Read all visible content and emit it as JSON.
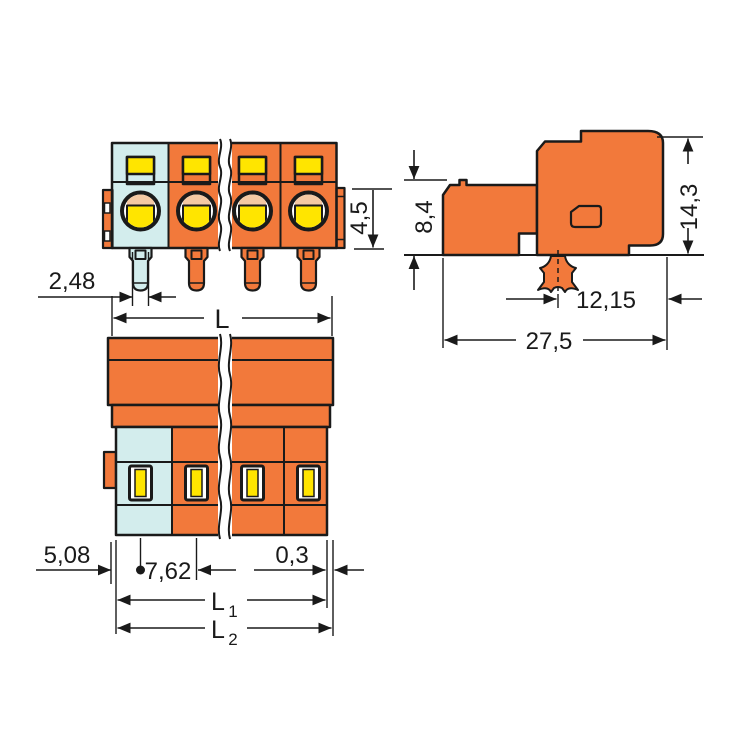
{
  "drawing_type": "connector-dimension-drawing",
  "colors": {
    "orange": "#F2793B",
    "cyan": "#D3EDED",
    "yellow": "#FFE500",
    "peach": "#F5C9A3",
    "line": "#1A1A1A",
    "background": "#FFFFFF"
  },
  "views": {
    "front": {
      "dims": {
        "pin_width": "2,48",
        "latch_height": "4,5",
        "length": "L"
      }
    },
    "side": {
      "dims": {
        "lower_height": "8,4",
        "total_height": "14,3",
        "foot_to_front": "12,15",
        "depth": "27,5"
      }
    },
    "top": {
      "dims": {
        "edge_to_pin1": "5,08",
        "pin_pitch": "7,62",
        "end_gap": "0,3",
        "l1_base": "L",
        "l1_sub": "1",
        "l2_base": "L",
        "l2_sub": "2"
      }
    }
  }
}
